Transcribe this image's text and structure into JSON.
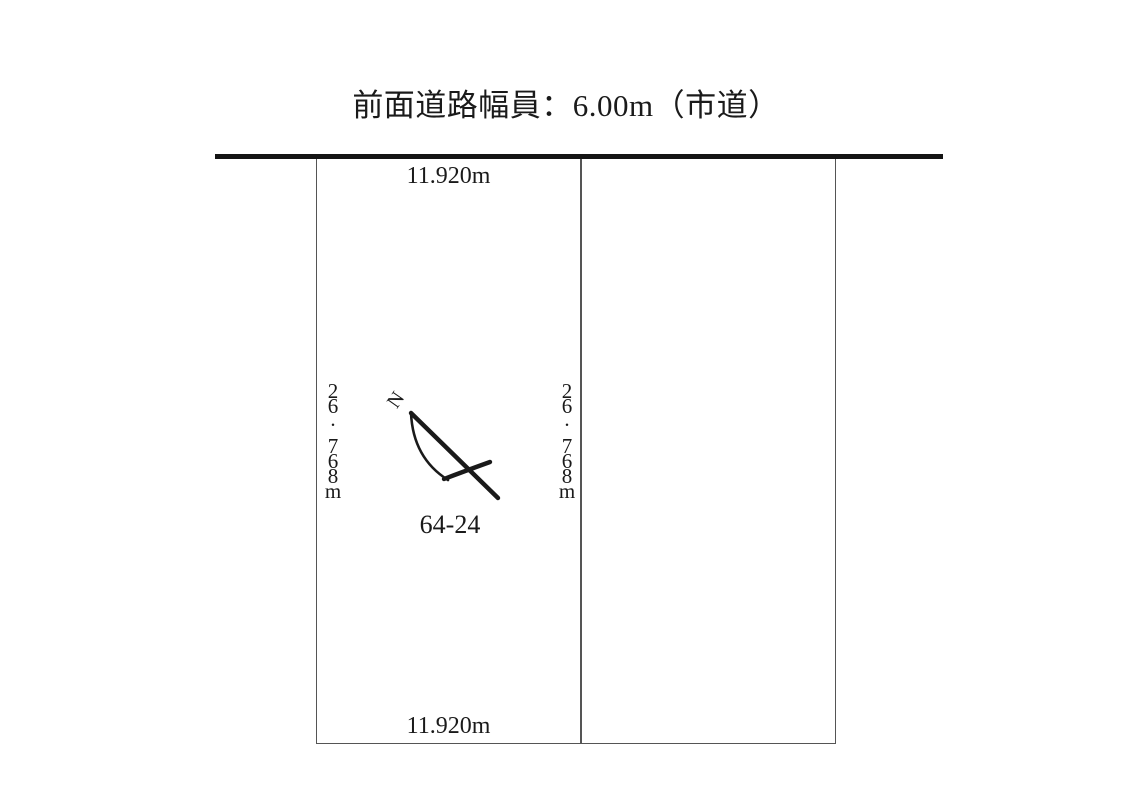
{
  "title": {
    "text": "前面道路幅員：6.00m（市道）"
  },
  "plot": {
    "parcel_number": "64-24",
    "dimensions": {
      "top": "11.920m",
      "bottom": "11.920m",
      "left": "26.768m",
      "right": "26.768m"
    }
  },
  "compass": {
    "north_label": "N"
  },
  "colors": {
    "road_line": "#141414",
    "boundary_line": "#555555",
    "text": "#1a1a1a",
    "background": "#ffffff"
  }
}
